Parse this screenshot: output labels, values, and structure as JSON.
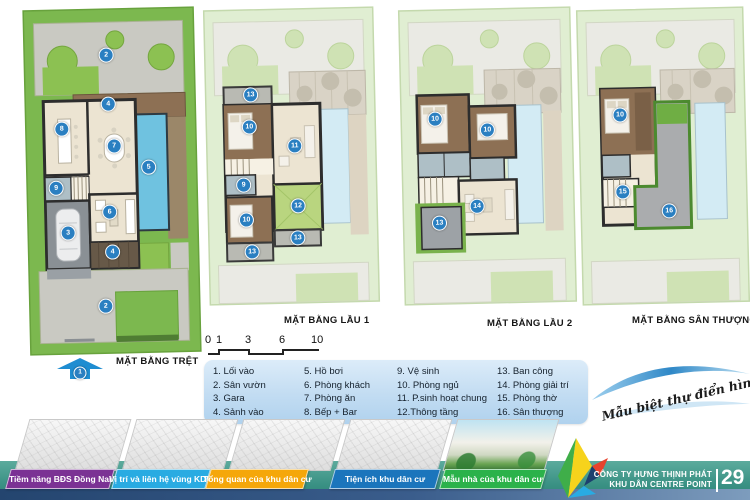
{
  "plans": [
    {
      "label": "MẶT BẰNG TRỆT",
      "entry_marker": "1",
      "markers": [
        "2",
        "4",
        "8",
        "7",
        "5",
        "9",
        "6",
        "3",
        "4",
        "2"
      ]
    },
    {
      "label": "MẶT BẰNG LẦU 1",
      "markers": [
        "13",
        "10",
        "11",
        "9",
        "12",
        "10",
        "13",
        "13"
      ]
    },
    {
      "label": "MẶT BẰNG LẦU 2",
      "markers": [
        "10",
        "10",
        "14",
        "13"
      ]
    },
    {
      "label": "MẶT BẰNG SÂN THƯỢNG",
      "markers": [
        "10",
        "15",
        "16"
      ]
    }
  ],
  "scalebar": {
    "ticks": [
      "0",
      "1",
      "3",
      "6",
      "10"
    ]
  },
  "legend": {
    "col1": [
      "1. Lối vào",
      "2. Sân vườn",
      "3. Gara",
      "4. Sảnh vào"
    ],
    "col2": [
      "5. Hồ bơi",
      "6. Phòng khách",
      "7. Phòng ăn",
      "8. Bếp + Bar"
    ],
    "col3": [
      "9. Vệ sinh",
      "10. Phòng ngủ",
      "11. P.sinh hoạt chung",
      "12.Thông tầng"
    ],
    "col4": [
      "13. Ban công",
      "14. Phòng giải trí",
      "15. Phòng thờ",
      "16. Sân thượng"
    ]
  },
  "tagline": "Mẫu biệt thự điển hình",
  "tabs": [
    {
      "label": "Tiềm năng BĐS Đồng Nai",
      "color": "#7B3294"
    },
    {
      "label": "Vị trí và liên hệ vùng KDC",
      "color": "#29ABE2"
    },
    {
      "label": "Tổng quan của khu dân cư",
      "color": "#F5A70A"
    },
    {
      "label": "Tiện ích khu dân cư",
      "color": "#1B75BC"
    },
    {
      "label": "Mẫu nhà của khu dân cư",
      "color": "#2BB24A"
    }
  ],
  "footer": {
    "company_line1": "CÔNG TY HƯNG THỊNH PHÁT",
    "company_line2": "KHU DÂN CENTRE POINT",
    "page": "29"
  },
  "colors": {
    "marker_blue": "#2a7fc1",
    "footer_teal": "#3a9184",
    "lawn_green": "#7cb84f",
    "pool_blue": "#6fc2e0"
  }
}
